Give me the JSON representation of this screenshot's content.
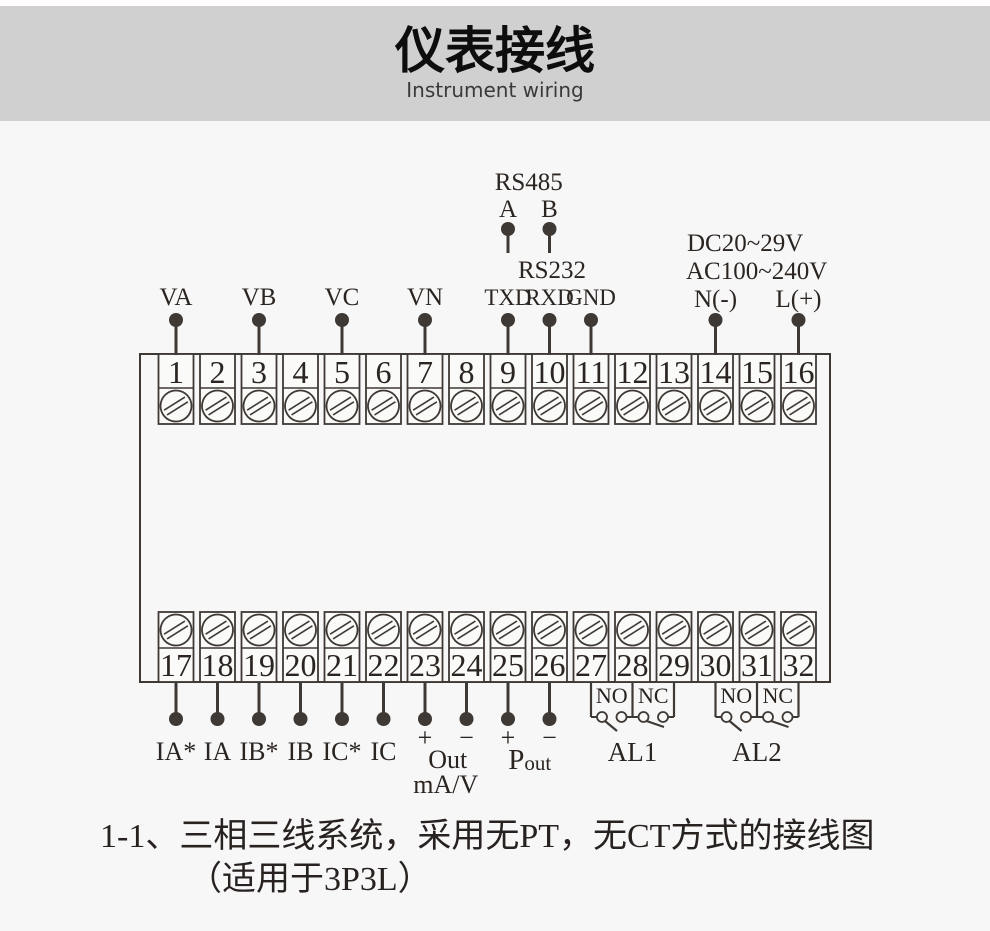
{
  "header": {
    "title": "仪表接线",
    "subtitle": "Instrument wiring"
  },
  "terminal_block": {
    "top_row": [
      "1",
      "2",
      "3",
      "4",
      "5",
      "6",
      "7",
      "8",
      "9",
      "10",
      "11",
      "12",
      "13",
      "14",
      "15",
      "16"
    ],
    "bottom_row": [
      "17",
      "18",
      "19",
      "20",
      "21",
      "22",
      "23",
      "24",
      "25",
      "26",
      "27",
      "28",
      "29",
      "30",
      "31",
      "32"
    ]
  },
  "top_labels": [
    {
      "terminal": 1,
      "label": "VA"
    },
    {
      "terminal": 3,
      "label": "VB"
    },
    {
      "terminal": 5,
      "label": "VC"
    },
    {
      "terminal": 7,
      "label": "VN"
    }
  ],
  "rs485": {
    "label": "RS485",
    "pins": [
      {
        "label": "A",
        "terminal": 9
      },
      {
        "label": "B",
        "terminal": 10
      }
    ]
  },
  "rs232": {
    "label": "RS232",
    "pins": [
      {
        "label": "TXD",
        "terminal": 9
      },
      {
        "label": "RXD",
        "terminal": 10
      },
      {
        "label": "GND",
        "terminal": 11
      }
    ]
  },
  "power_supply": {
    "line1": "DC20~29V",
    "line2": "AC100~240V",
    "neutral": {
      "label": "N(-)",
      "terminal": 14
    },
    "live": {
      "label": "L(+)",
      "terminal": 16
    }
  },
  "bottom_labels": [
    {
      "terminal": 17,
      "label": "IA*"
    },
    {
      "terminal": 18,
      "label": "IA"
    },
    {
      "terminal": 19,
      "label": "IB*"
    },
    {
      "terminal": 20,
      "label": "IB"
    },
    {
      "terminal": 21,
      "label": "IC*"
    },
    {
      "terminal": 22,
      "label": "IC"
    }
  ],
  "analog_output": {
    "plus_label": "+",
    "minus_label": "−",
    "plus_terminal": 23,
    "minus_terminal": 24,
    "label": "Out",
    "unit": "mA/V"
  },
  "pulse_output": {
    "plus_label": "+",
    "minus_label": "−",
    "plus_terminal": 25,
    "minus_terminal": 26,
    "label_main": "P",
    "label_sub": "out"
  },
  "relays": [
    {
      "label": "AL1",
      "terminals": [
        27,
        28,
        29
      ],
      "contacts": [
        "NO",
        "NC"
      ]
    },
    {
      "label": "AL2",
      "terminals": [
        30,
        31,
        32
      ],
      "contacts": [
        "NO",
        "NC"
      ]
    }
  ],
  "caption": {
    "line1": "1-1、三相三线系统，采用无PT，无CT方式的接线图",
    "line2": "（适用于3P3L）"
  },
  "colors": {
    "line": "#3f3935",
    "text": "#2b2522",
    "banner": "#d0d0d0",
    "background": "#f7f7f7",
    "cell": "#fafaf8"
  }
}
